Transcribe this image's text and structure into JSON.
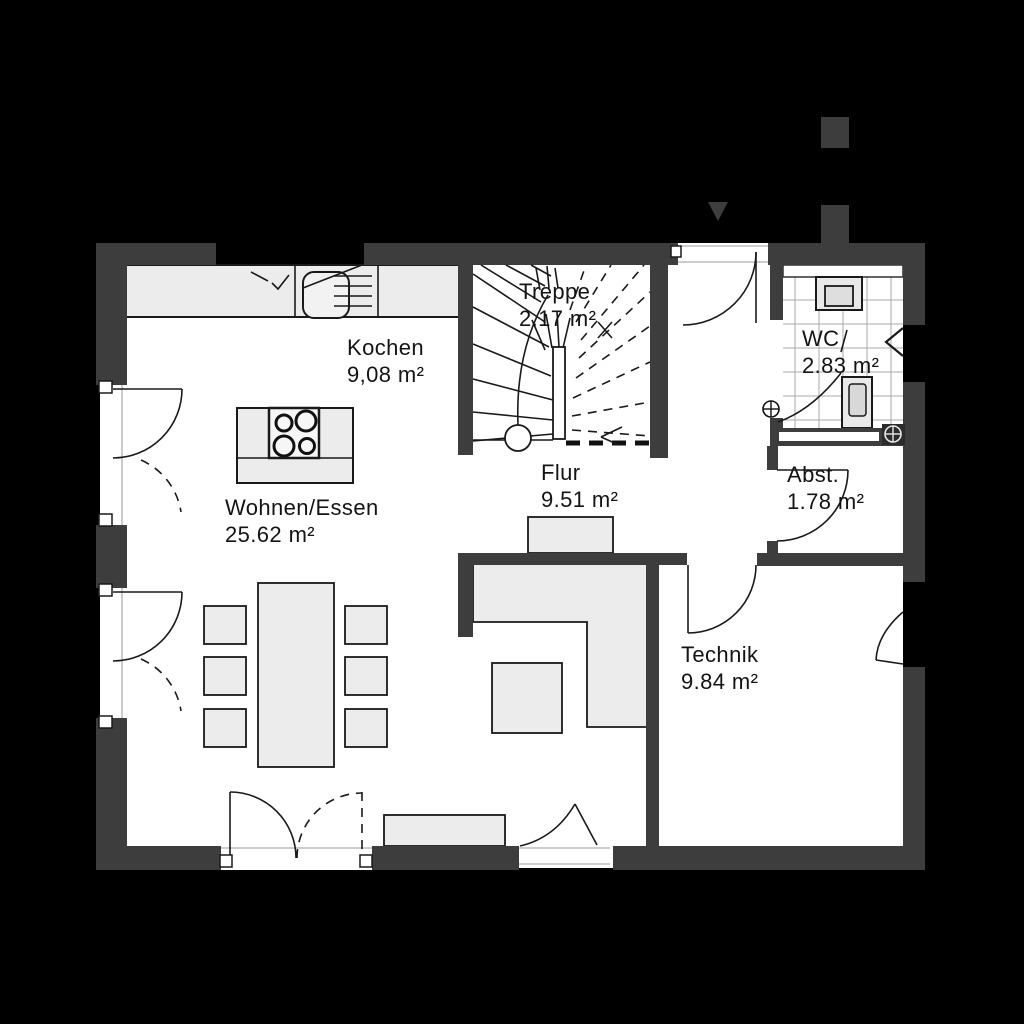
{
  "document": {
    "type": "floor-plan",
    "style": "architectural ground-floor plan, black background, dark grey walls, white rooms"
  },
  "colors": {
    "background": "#000000",
    "wall": "#3d3d3d",
    "floor": "#ffffff",
    "furniture_fill": "#ececec",
    "line": "#1a1a1a",
    "tile_grid": "#a8a8a8"
  },
  "rooms": [
    {
      "name": "Kochen",
      "area": "9,08 m²"
    },
    {
      "name": "Treppe",
      "area": "2.17 m²"
    },
    {
      "name": "WC",
      "area": "2.83 m²"
    },
    {
      "name": "Flur",
      "area": "9.51 m²"
    },
    {
      "name": "Wohnen/Essen",
      "area": "25.62 m²"
    },
    {
      "name": "Abst.",
      "area": "1.78 m²"
    },
    {
      "name": "Technik",
      "area": "9.84 m²"
    }
  ],
  "fixtures": [
    "kitchen-counter",
    "kitchen-sink",
    "kitchen-island",
    "cooktop",
    "dining-table",
    "chair",
    "sofa",
    "coffee-table",
    "hall-wardrobe",
    "sideboard",
    "washbasin",
    "toilet",
    "staircase"
  ],
  "symbols": [
    "entrance-arrow",
    "chimney-block",
    "drain-symbol",
    "door-swing",
    "french-window",
    "section-cut-line"
  ]
}
